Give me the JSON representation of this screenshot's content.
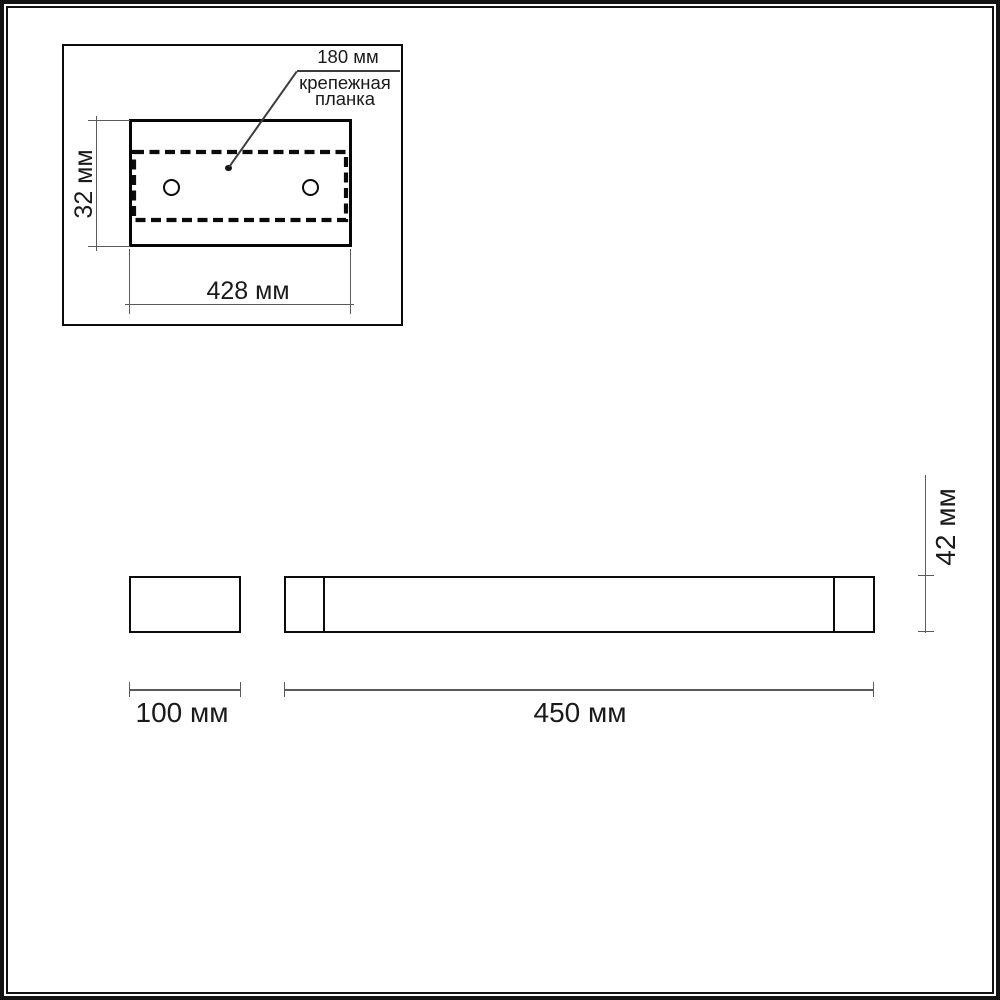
{
  "colors": {
    "ink": "#0b0b0b",
    "dimension_line": "#5a5a5a",
    "background": "#ffffff"
  },
  "inset": {
    "bracket_length_label": "180 мм",
    "bracket_caption_line1": "крепежная",
    "bracket_caption_line2": "планка",
    "plate_height_label": "32 мм",
    "plate_width_label": "428 мм"
  },
  "side_view": {
    "bracket_depth_label": "100 мм",
    "body_length_label": "450 мм",
    "body_height_label": "42 мм"
  }
}
